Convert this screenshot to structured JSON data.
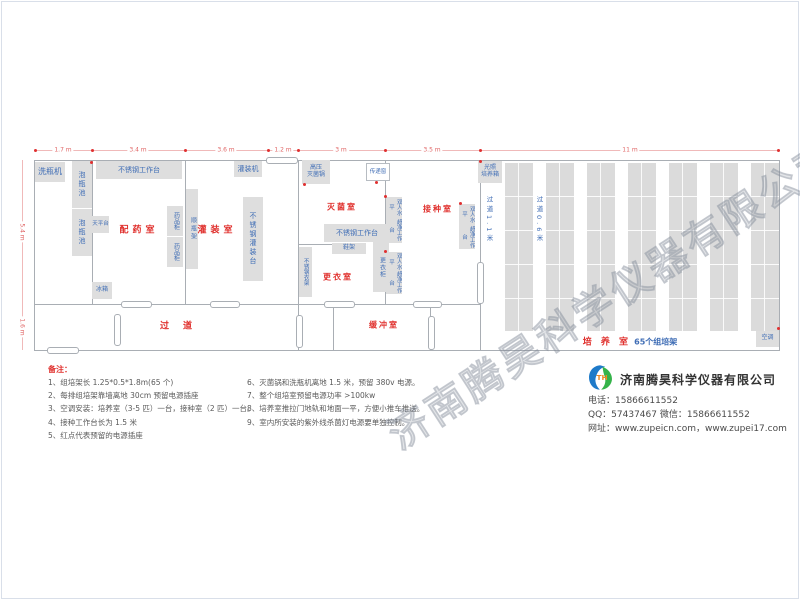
{
  "watermark": "济南腾昊科学仪器有限公司",
  "dims": {
    "top": [
      "1.7 m",
      "3.4 m",
      "3.6 m",
      "1.2 m",
      "3 m",
      "3.5 m",
      "11 m"
    ],
    "left": [
      "5.4 m",
      "1.6 m"
    ]
  },
  "rooms": {
    "peiyao": "配药室",
    "guanzhuang": "灌装室",
    "miejun": "灭菌室",
    "gengyi": "更衣室",
    "jiezhong": "接种室",
    "guodao": "过道",
    "huanchong": "缓冲室",
    "peiyang": "培 养 室",
    "peiyang_sub": "65个组培架",
    "aisle_1": "过道1.1米",
    "aisle_2": "过道0.6米"
  },
  "equipment": {
    "wash_machine": "洗瓶机",
    "soak_pool": "泡瓶池",
    "ss_worktable": "不锈钢工作台",
    "balance_table": "天平台",
    "medicine_cabinet": "药品柜",
    "bottle_rack": "顺瓶架",
    "fridge": "冰箱",
    "ss_fill_table": "不锈钢灌装台",
    "fill_machine": "灌装机",
    "autoclave_l1": "高压",
    "autoclave_l2": "灭菌锅",
    "pass_window": "传递窗",
    "shoe_rack": "鞋架",
    "wardrobe": "更衣柜",
    "ss_clothes_rack": "不锈钢衣架",
    "bench_l1": "双人水平",
    "bench_l2": "超净工作台",
    "incubator_l1": "光照",
    "incubator_l2": "培养箱",
    "air_conditioner": "空调"
  },
  "culture_room": {
    "rack_columns": 7
  },
  "notes": {
    "title": "备注：",
    "col1": [
      "1、组培架长 1.25*0.5*1.8m(65 个)",
      "2、每排组培架靠墙离地 30cm 预留电源插座",
      "3、空调安装：培养室（3-5 匹）一台，接种室（2 匹）一台。",
      "4、接种工作台长为 1.5 米",
      "5、红点代表预留的电源插座"
    ],
    "col2": [
      "6、灭菌锅和洗瓶机离地 1.5 米，预留 380v 电源。",
      "7、整个组培室预留电源功率 >100kw",
      "8、培养室推拉门地轨和地面一平，方便小推车推送。",
      "9、室内所安装的紫外线杀菌灯电源要单独控制。"
    ]
  },
  "company": {
    "name": "济南腾昊科学仪器有限公司",
    "logo_text": "TH",
    "phone_line": "电话：15866611552",
    "qq_line": "QQ：57437467  微信：15866611552",
    "web_line": "网址：www.zupeicn.com，www.zupei17.com"
  }
}
